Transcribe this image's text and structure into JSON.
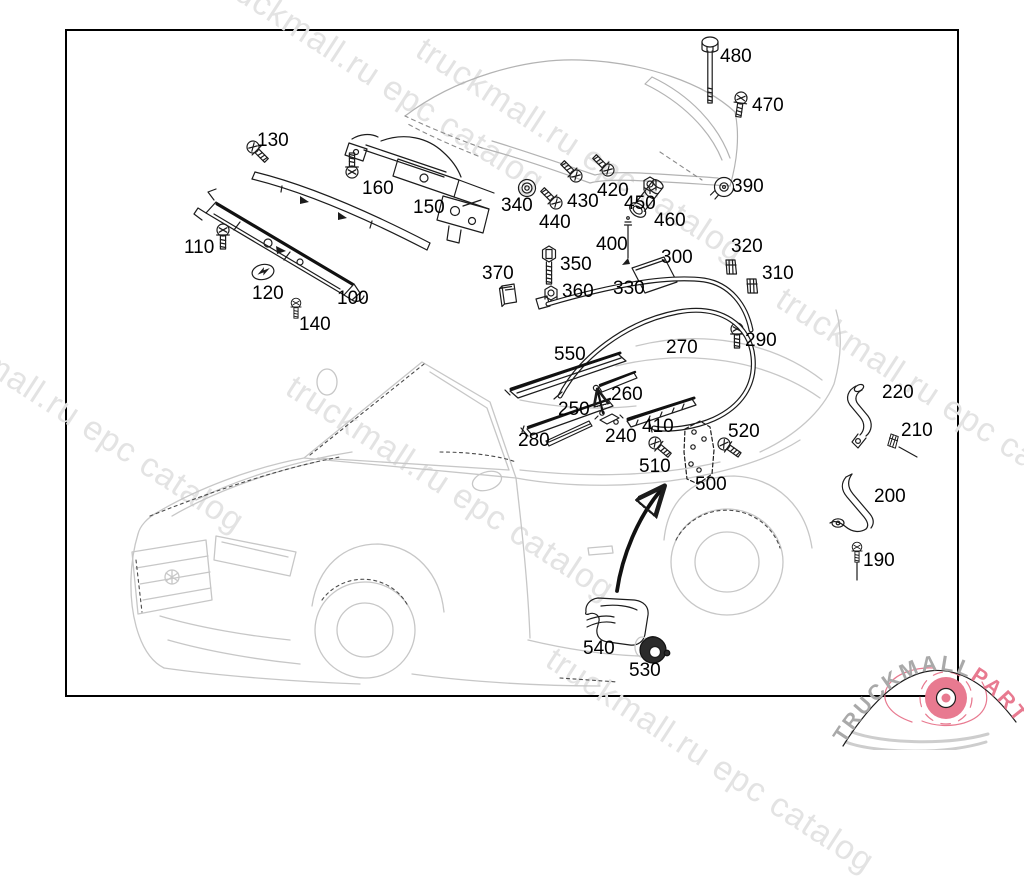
{
  "watermark": {
    "text": "truckmall.ru epc catalog",
    "color": "#e3e3e3",
    "instances": [
      {
        "x": -70,
        "y": 300
      },
      {
        "x": 230,
        "y": -40
      },
      {
        "x": 430,
        "y": 30
      },
      {
        "x": 300,
        "y": 368
      },
      {
        "x": 790,
        "y": 280
      },
      {
        "x": 560,
        "y": 640
      }
    ]
  },
  "logo": {
    "brand": "TRUCKMALL",
    "suffix": "PARTS",
    "brand_color": "#a9a9a9",
    "accent_color": "#e87a90"
  },
  "diagram": {
    "description": "exploded parts diagram of convertible hardtop roof attachment parts",
    "border_color": "#000000",
    "labels": [
      {
        "t": "480",
        "x": 720,
        "y": 46
      },
      {
        "t": "470",
        "x": 752,
        "y": 95
      },
      {
        "t": "130",
        "x": 257,
        "y": 130
      },
      {
        "t": "160",
        "x": 362,
        "y": 178
      },
      {
        "t": "150",
        "x": 413,
        "y": 197
      },
      {
        "t": "340",
        "x": 501,
        "y": 195
      },
      {
        "t": "440",
        "x": 539,
        "y": 212
      },
      {
        "t": "430",
        "x": 567,
        "y": 191
      },
      {
        "t": "420",
        "x": 597,
        "y": 180
      },
      {
        "t": "450",
        "x": 624,
        "y": 193
      },
      {
        "t": "460",
        "x": 654,
        "y": 210
      },
      {
        "t": "390",
        "x": 732,
        "y": 176
      },
      {
        "t": "110",
        "x": 184,
        "y": 237
      },
      {
        "t": "120",
        "x": 252,
        "y": 283
      },
      {
        "t": "140",
        "x": 299,
        "y": 314
      },
      {
        "t": "100",
        "x": 337,
        "y": 288
      },
      {
        "t": "370",
        "x": 482,
        "y": 263
      },
      {
        "t": "350",
        "x": 560,
        "y": 254
      },
      {
        "t": "360",
        "x": 562,
        "y": 281
      },
      {
        "t": "400",
        "x": 596,
        "y": 234
      },
      {
        "t": "330",
        "x": 613,
        "y": 278
      },
      {
        "t": "300",
        "x": 661,
        "y": 247
      },
      {
        "t": "320",
        "x": 731,
        "y": 236
      },
      {
        "t": "310",
        "x": 762,
        "y": 263
      },
      {
        "t": "290",
        "x": 745,
        "y": 330
      },
      {
        "t": "550",
        "x": 554,
        "y": 344
      },
      {
        "t": "270",
        "x": 666,
        "y": 337
      },
      {
        "t": "250",
        "x": 558,
        "y": 399
      },
      {
        "t": "260",
        "x": 611,
        "y": 384
      },
      {
        "t": "240",
        "x": 605,
        "y": 426
      },
      {
        "t": "280",
        "x": 518,
        "y": 430
      },
      {
        "t": "410",
        "x": 642,
        "y": 416
      },
      {
        "t": "510",
        "x": 639,
        "y": 456
      },
      {
        "t": "500",
        "x": 695,
        "y": 474
      },
      {
        "t": "520",
        "x": 728,
        "y": 421
      },
      {
        "t": "220",
        "x": 882,
        "y": 382
      },
      {
        "t": "210",
        "x": 901,
        "y": 420
      },
      {
        "t": "200",
        "x": 874,
        "y": 486
      },
      {
        "t": "190",
        "x": 863,
        "y": 550
      },
      {
        "t": "540",
        "x": 583,
        "y": 638
      },
      {
        "t": "530",
        "x": 629,
        "y": 660
      }
    ]
  }
}
